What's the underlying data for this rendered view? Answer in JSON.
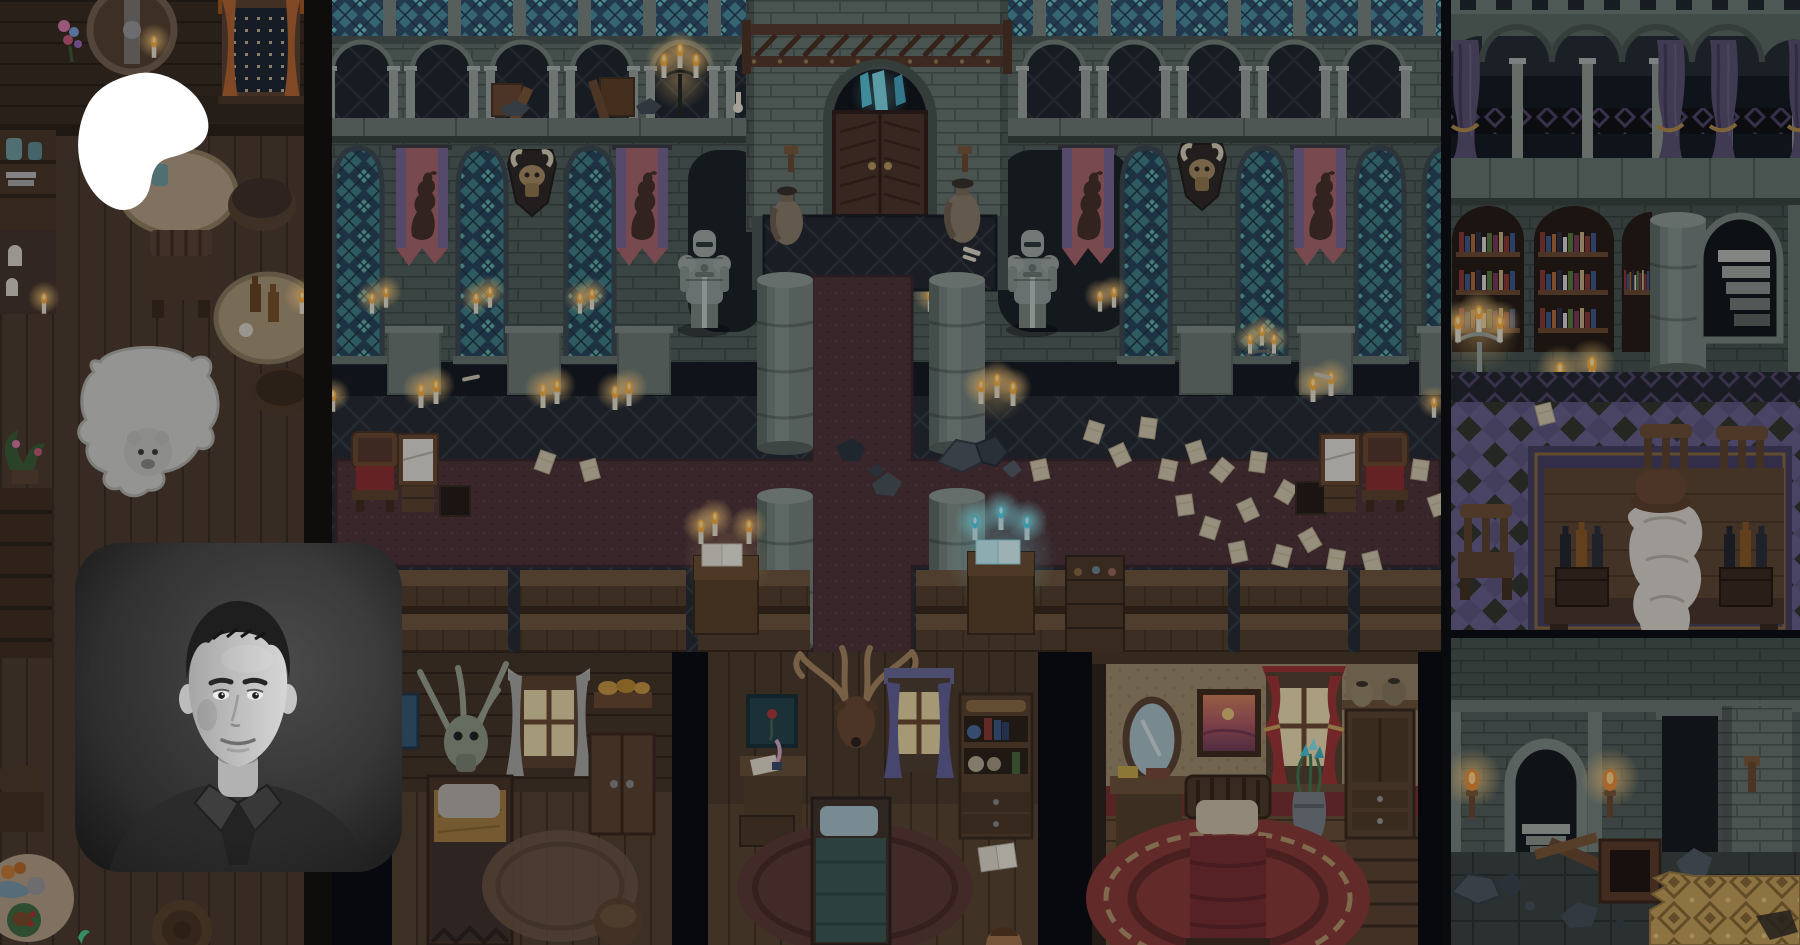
{
  "branding": {
    "logo_icon": "patreon-logo-icon",
    "logo_color": "#ffffff",
    "logo_aria_label": "Patreon"
  },
  "profile": {
    "avatar_icon": "creator-portrait-photo",
    "avatar_style": "black-and-white portrait photo",
    "avatar_aria_label": "Creator profile photo"
  },
  "banner": {
    "art_style": "pixel-art RPG interior collage",
    "scenes": [
      "tavern interior with bear rug",
      "great hall with stained glass, heraldic banners and knight statues",
      "log cabin bedrooms",
      "library study with bookshelves",
      "dungeon corridor with torches"
    ],
    "palette": {
      "stone": "#5c6a64",
      "stained_glass_teal": "#4a8fa0",
      "banner_pink": "#a9666c",
      "banner_purple": "#776896",
      "wood_brown": "#4a3828",
      "candle_flame": "#ffb23e",
      "magic_cyan": "#7ae0ea",
      "library_floor_purple": "#67608a",
      "gold_carpet": "#c7a258",
      "dim_overlay": "#06060c"
    }
  }
}
